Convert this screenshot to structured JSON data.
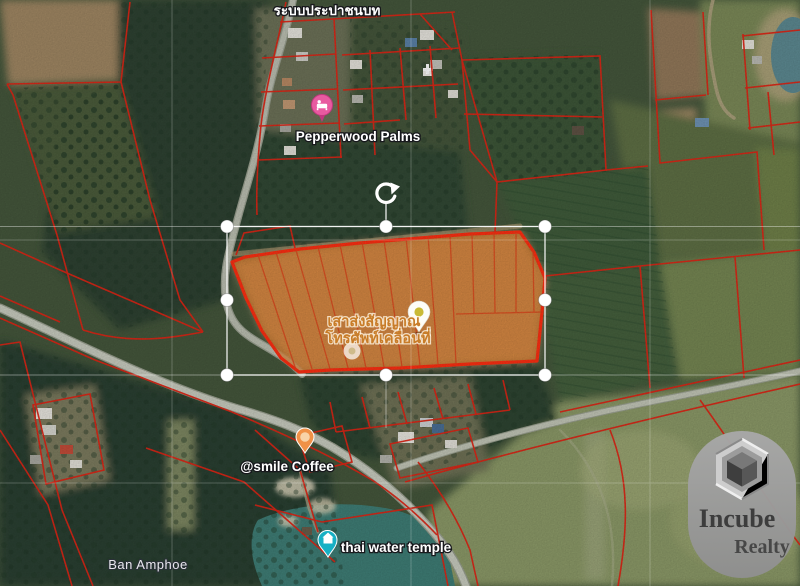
{
  "map": {
    "place_labels": {
      "water_system": "ระบบประปาชนบท",
      "lodging": "Pepperwood Palms",
      "tower_line1": "เสาส่งสัญญาณ",
      "tower_line2": "โทรศัพท์เคลื่อนที่",
      "coffee": "@smile Coffee",
      "temple": "thai water temple",
      "town": "Ban Amphoe"
    },
    "pins": [
      {
        "id": "lodging-pin",
        "label_for": "Pepperwood Palms",
        "color": "#e85aa0"
      },
      {
        "id": "tower-pin",
        "label_for": "เสาส่งสัญญาณโทรศัพท์เคลื่อนที่",
        "color": "#c9ba35"
      },
      {
        "id": "coffee-pin",
        "label_for": "@smile Coffee",
        "color": "#f09147"
      },
      {
        "id": "temple-pin",
        "label_for": "thai water temple",
        "color": "#17b0c4"
      }
    ]
  },
  "selection": {
    "handles": [
      "top-left",
      "top-center",
      "top-right",
      "middle-left",
      "middle-right",
      "bottom-left",
      "bottom-center",
      "bottom-right"
    ],
    "rotate_handle": true
  },
  "watermark": {
    "name": "Incube",
    "tagline": "Realty"
  },
  "colors": {
    "parcel_line_red": "#e02616",
    "selected_parcel_fill": "#e87e25",
    "selected_parcel_outline": "#ff2f12",
    "selection_white": "#ffffff",
    "pin_lodging": "#e85aa0",
    "pin_coffee": "#f09147",
    "pin_temple": "#17b0c4",
    "pin_tower_dot": "#c9ba35",
    "thai_label_orange": "#c87c28",
    "watermark_pill": "#9c9c9c",
    "forest_green": "#2d4230",
    "field_green": "#8c9a68",
    "pond_teal": "#3f7e76"
  }
}
